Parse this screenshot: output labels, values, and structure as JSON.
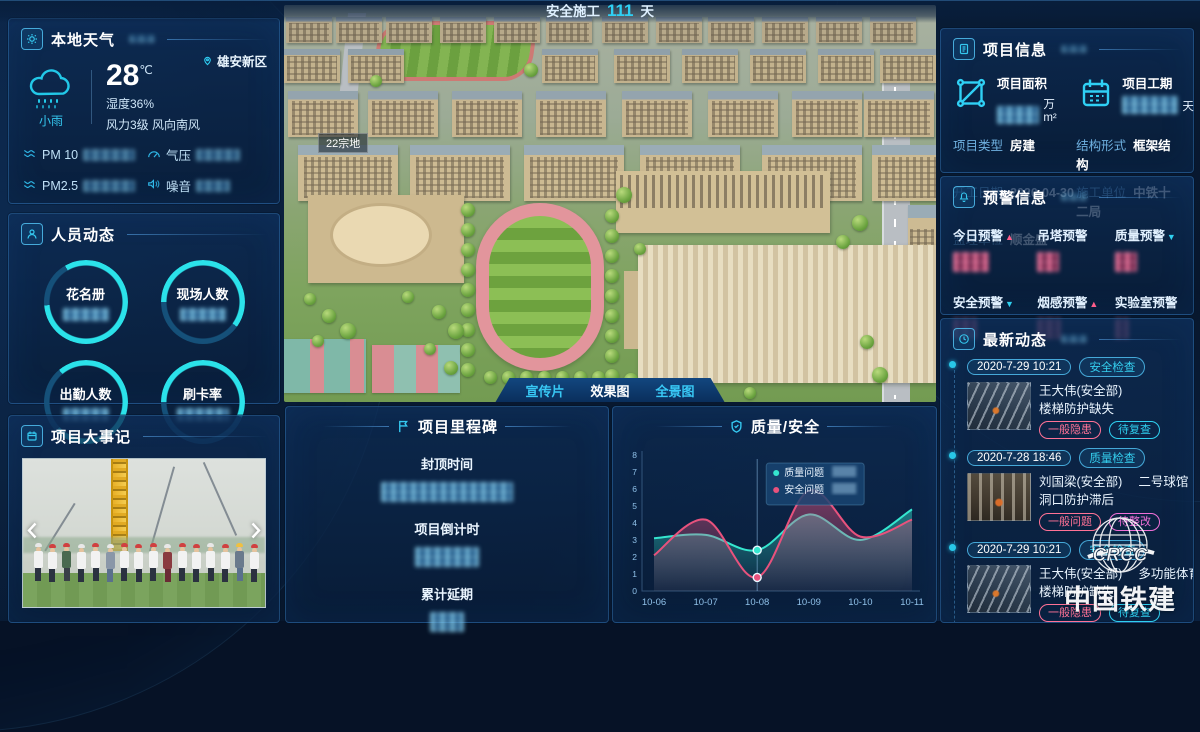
{
  "header": {
    "prefix": "安全施工",
    "days": "111",
    "suffix": "天"
  },
  "weather": {
    "title": "本地天气",
    "location": "雄安新区",
    "condition": "小雨",
    "temperature": "28",
    "temp_unit": "℃",
    "humidity": "湿度36%",
    "wind": "风力3级 风向南风",
    "stats": [
      {
        "label": "PM 10",
        "value_redacted": true
      },
      {
        "label": "气压",
        "value_redacted": true
      },
      {
        "label": "PM2.5",
        "value_redacted": true
      },
      {
        "label": "噪音",
        "value_redacted": true
      }
    ]
  },
  "personnel": {
    "title": "人员动态",
    "rings": [
      {
        "label": "花名册",
        "value_redacted": true
      },
      {
        "label": "现场人数",
        "value_redacted": true
      },
      {
        "label": "出勤人数",
        "value_redacted": true
      },
      {
        "label": "刷卡率",
        "value_redacted": true
      }
    ]
  },
  "events": {
    "title": "项目大事记"
  },
  "main_view": {
    "land_label": "22宗地",
    "buttons": [
      {
        "label": "宣传片",
        "active": false
      },
      {
        "label": "效果图",
        "active": true
      },
      {
        "label": "全景图",
        "active": false
      }
    ]
  },
  "milestone": {
    "title": "项目里程碑",
    "items": [
      {
        "label": "封顶时间",
        "value_redacted": true
      },
      {
        "label": "项目倒计时",
        "value_redacted": true
      },
      {
        "label": "累计延期",
        "value_redacted": true
      }
    ]
  },
  "quality_safety": {
    "title": "质量/安全"
  },
  "project_info": {
    "title": "项目信息",
    "area_label": "项目面积",
    "area_unit": "万m²",
    "duration_label": "项目工期",
    "duration_unit": "天",
    "rows": [
      {
        "label": "项目类型",
        "value": "房建"
      },
      {
        "label": "结构形式",
        "value": "框架结构"
      },
      {
        "label": "开工日期",
        "value": "2020-04-30"
      },
      {
        "label": "施工单位",
        "value": "中铁十二局"
      },
      {
        "label": "监理单位",
        "value": "顺金盛"
      }
    ]
  },
  "alerts": {
    "title": "预警信息",
    "items": [
      {
        "label": "今日预警",
        "trend": "up",
        "value_redacted": true
      },
      {
        "label": "吊塔预警",
        "trend": "none",
        "value_redacted": true
      },
      {
        "label": "质量预警",
        "trend": "down",
        "value_redacted": true
      },
      {
        "label": "安全预警",
        "trend": "down",
        "value_redacted": true
      },
      {
        "label": "烟感预警",
        "trend": "up",
        "value_redacted": true
      },
      {
        "label": "实验室预警",
        "trend": "none",
        "value_redacted": true
      }
    ]
  },
  "feed": {
    "title": "最新动态",
    "items": [
      {
        "date": "2020-7-29 10:21",
        "type": "安全检查",
        "person": "王大伟(安全部)",
        "location": "",
        "issue": "楼梯防护缺失",
        "badge1": "一般隐患",
        "badge2": "待复查"
      },
      {
        "date": "2020-7-28 18:46",
        "type": "质量检查",
        "person": "刘国梁(安全部)",
        "location": "二号球馆",
        "issue": "洞口防护滞后",
        "badge1": "一般问题",
        "badge2": "待整改"
      },
      {
        "date": "2020-7-29 10:21",
        "type": "安全检查",
        "person": "王大伟(安全部)",
        "location": "多功能体育馆",
        "issue": "楼梯防护缺失",
        "badge1": "一般隐患",
        "badge2": "待复查"
      },
      {
        "date": "2020-7-28 18:46",
        "type": "质量检查",
        "person": "刘国梁(安全部)",
        "location": "",
        "issue": "",
        "badge1": "",
        "badge2": ""
      }
    ]
  },
  "logo": {
    "abbr": "CRCC",
    "name": "中国铁建"
  },
  "colors": {
    "accent_cyan": "#2fd0f5",
    "accent_pink": "#e8527d",
    "panel_border": "#3a82c8"
  },
  "chart_data": {
    "type": "area",
    "title": "质量/安全",
    "x": [
      "10-06",
      "10-07",
      "10-08",
      "10-09",
      "10-10",
      "10-11"
    ],
    "series": [
      {
        "name": "质量问题",
        "color": "#35e6cf",
        "values": [
          3.1,
          3.3,
          2.4,
          4.5,
          3.0,
          4.8
        ]
      },
      {
        "name": "安全问题",
        "color": "#e8527d",
        "values": [
          2.1,
          4.2,
          0.8,
          5.9,
          3.2,
          4.2
        ]
      }
    ],
    "ylim": [
      0,
      8
    ],
    "y_ticks": [
      0,
      1,
      2,
      3,
      4,
      5,
      6,
      7,
      8
    ],
    "xlabel": "",
    "ylabel": "",
    "grid": false,
    "legend_position": "tooltip",
    "highlight_x": "10-08",
    "highlight_values_redacted": true
  }
}
